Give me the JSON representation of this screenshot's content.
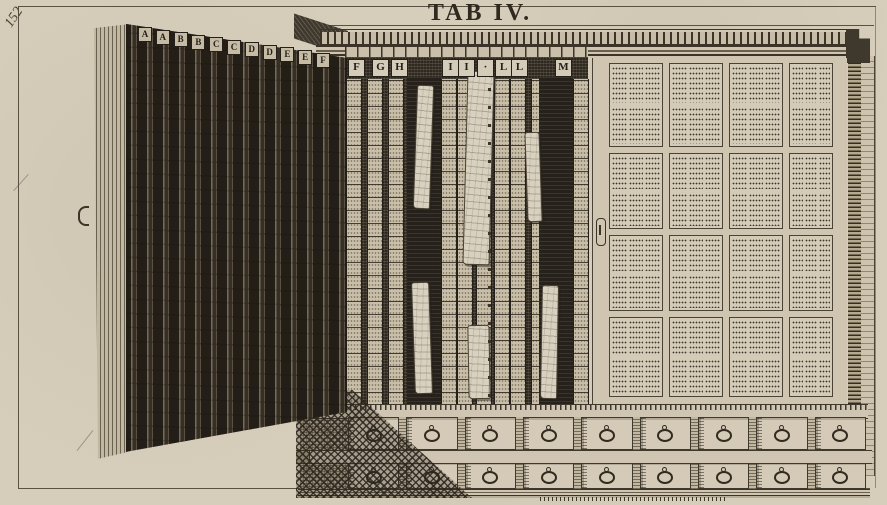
{
  "palette": {
    "paper": "#d6cdbb",
    "ink": "#3a3327",
    "wood_dark": "#4a4234",
    "cell_light": "#cfc5b0"
  },
  "plate": {
    "page_number": "152",
    "title": "TAB IV."
  },
  "left_door": {
    "letters": [
      "A",
      "A",
      "B",
      "B",
      "C",
      "C",
      "D",
      "D",
      "E",
      "E",
      "F"
    ]
  },
  "cabinet": {
    "column_letters": [
      "F",
      "G",
      "H",
      "I",
      "I",
      "·",
      "L",
      "L",
      "M"
    ],
    "right_panel": {
      "rows": 4,
      "cols": 4
    },
    "specimen_sheet_count": 6,
    "drawer_rows": [
      {
        "count": 9
      },
      {
        "count": 9
      }
    ]
  }
}
